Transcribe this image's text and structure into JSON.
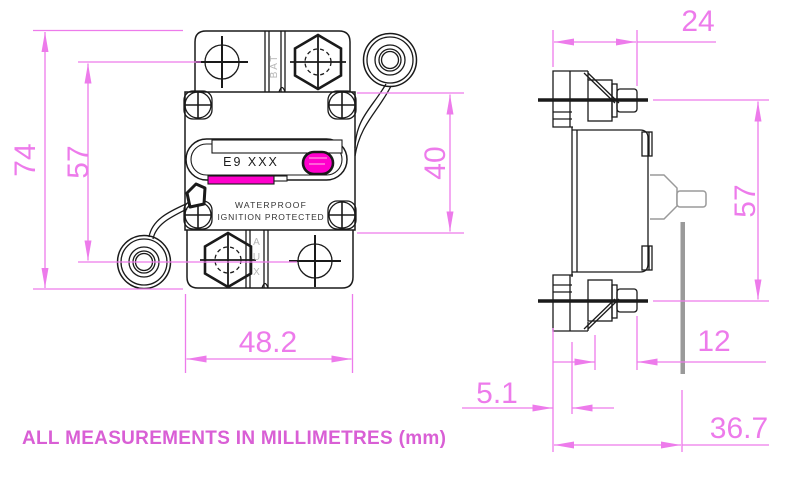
{
  "note": "ALL MEASUREMENTS IN MILLIMETRES (mm)",
  "units": "mm",
  "front_view": {
    "label": "E9 XXX",
    "marking_line1": "WATERPROOF",
    "marking_line2": "IGNITION PROTECTED",
    "terminal_top_marking": "BAT",
    "terminal_bottom_marking": "AUX",
    "dim_overall_height": "74",
    "dim_mount_hole_spacing": "57",
    "dim_body_height": "40",
    "dim_body_width": "48.2"
  },
  "side_view": {
    "dim_top_depth": "24",
    "dim_terminal_spacing": "57",
    "dim_stud_length": "12",
    "dim_flange_thickness": "5.1",
    "dim_overall_depth": "36.7"
  },
  "colors": {
    "dimension_magenta": "#ed7beb",
    "highlight_magenta": "#ff00cc",
    "note_magenta": "#d95fd5",
    "line_black": "#1a1a1a",
    "detail_gray": "#9a9a9a"
  }
}
